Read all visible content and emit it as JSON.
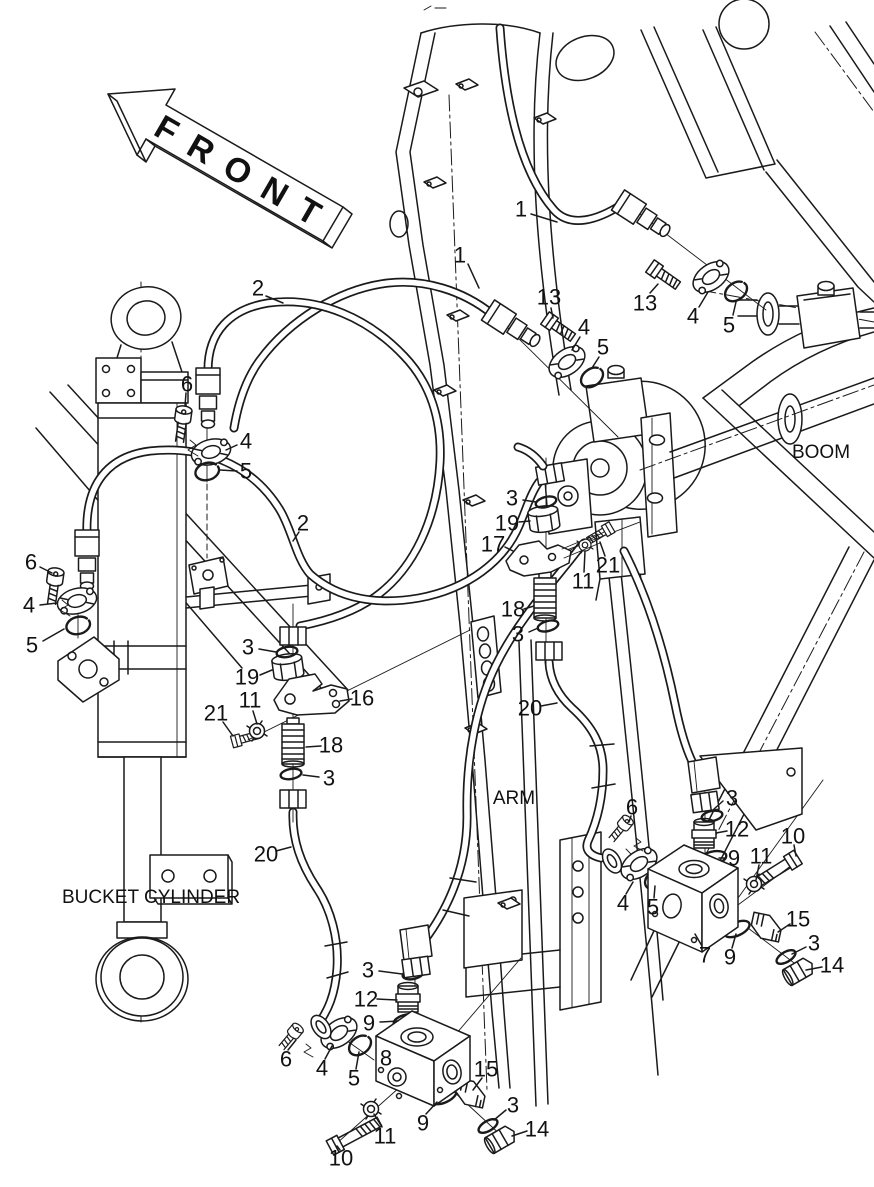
{
  "diagram": {
    "type": "exploded-parts-diagram",
    "labels": {
      "front": "FRONT",
      "boom": "BOOM",
      "arm": "ARM",
      "bucket_cylinder": "BUCKET CYLINDER"
    },
    "watermark": "www.simbrottoo.kz",
    "colors": {
      "line": "#1a1a1a",
      "background": "#ffffff",
      "watermark": "#bdbdbd"
    },
    "callouts": [
      {
        "n": "1",
        "x": 460,
        "y": 255,
        "leader": [
          468,
          264,
          479,
          288
        ]
      },
      {
        "n": "1",
        "x": 521,
        "y": 209,
        "leader": [
          531,
          214,
          557,
          222
        ]
      },
      {
        "n": "2",
        "x": 258,
        "y": 288,
        "leader": [
          266,
          296,
          283,
          303
        ]
      },
      {
        "n": "13",
        "x": 549,
        "y": 297,
        "leader": [
          551,
          308,
          553,
          318
        ]
      },
      {
        "n": "4",
        "x": 584,
        "y": 327,
        "leader": [
          580,
          337,
          572,
          350
        ]
      },
      {
        "n": "5",
        "x": 603,
        "y": 347,
        "leader": [
          599,
          357,
          592,
          368
        ]
      },
      {
        "n": "13",
        "x": 645,
        "y": 303,
        "leader": [
          650,
          293,
          658,
          284
        ]
      },
      {
        "n": "4",
        "x": 693,
        "y": 316,
        "leader": [
          699,
          307,
          708,
          292
        ]
      },
      {
        "n": "5",
        "x": 729,
        "y": 325,
        "leader": [
          733,
          315,
          736,
          302
        ]
      },
      {
        "n": "6",
        "x": 187,
        "y": 384,
        "leader": [
          186,
          393,
          185,
          406
        ]
      },
      {
        "n": "4",
        "x": 246,
        "y": 441,
        "leader": [
          237,
          445,
          226,
          450
        ]
      },
      {
        "n": "5",
        "x": 246,
        "y": 471,
        "leader": [
          237,
          471,
          220,
          470
        ]
      },
      {
        "n": "2",
        "x": 303,
        "y": 523,
        "leader": [
          299,
          532,
          293,
          541
        ]
      },
      {
        "n": "6",
        "x": 31,
        "y": 562,
        "leader": [
          40,
          567,
          52,
          573
        ]
      },
      {
        "n": "4",
        "x": 29,
        "y": 605,
        "leader": [
          40,
          605,
          57,
          603
        ]
      },
      {
        "n": "5",
        "x": 32,
        "y": 645,
        "leader": [
          43,
          641,
          64,
          629
        ]
      },
      {
        "n": "3",
        "x": 248,
        "y": 647,
        "leader": [
          259,
          649,
          276,
          652
        ]
      },
      {
        "n": "19",
        "x": 247,
        "y": 677,
        "leader": [
          260,
          675,
          272,
          670
        ]
      },
      {
        "n": "11",
        "x": 250,
        "y": 700,
        "leader": [
          253,
          711,
          257,
          724
        ]
      },
      {
        "n": "21",
        "x": 216,
        "y": 713,
        "leader": [
          223,
          722,
          233,
          736
        ]
      },
      {
        "n": "16",
        "x": 362,
        "y": 698,
        "leader": [
          352,
          699,
          340,
          701
        ]
      },
      {
        "n": "18",
        "x": 331,
        "y": 745,
        "leader": [
          321,
          746,
          306,
          747
        ]
      },
      {
        "n": "3",
        "x": 329,
        "y": 778,
        "leader": [
          319,
          777,
          303,
          775
        ]
      },
      {
        "n": "20",
        "x": 266,
        "y": 854,
        "leader": [
          276,
          851,
          291,
          847
        ]
      },
      {
        "n": "3",
        "x": 512,
        "y": 498,
        "leader": [
          523,
          500,
          536,
          502
        ]
      },
      {
        "n": "19",
        "x": 507,
        "y": 523,
        "leader": [
          519,
          522,
          530,
          521
        ]
      },
      {
        "n": "17",
        "x": 493,
        "y": 544,
        "leader": [
          505,
          547,
          513,
          551
        ]
      },
      {
        "n": "21",
        "x": 608,
        "y": 565,
        "leader": [
          605,
          556,
          600,
          542
        ]
      },
      {
        "n": "11",
        "x": 583,
        "y": 581,
        "leader": [
          584,
          572,
          585,
          551
        ]
      },
      {
        "n": "18",
        "x": 513,
        "y": 609,
        "leader": [
          524,
          609,
          534,
          606
        ]
      },
      {
        "n": "3",
        "x": 518,
        "y": 634,
        "leader": [
          529,
          632,
          538,
          628
        ]
      },
      {
        "n": "20",
        "x": 530,
        "y": 708,
        "leader": [
          541,
          706,
          557,
          703
        ]
      },
      {
        "n": "6",
        "x": 632,
        "y": 807,
        "leader": [
          631,
          816,
          629,
          822
        ]
      },
      {
        "n": "3",
        "x": 732,
        "y": 798,
        "leader": [
          723,
          801,
          714,
          809
        ]
      },
      {
        "n": "12",
        "x": 737,
        "y": 829,
        "leader": [
          727,
          831,
          716,
          833
        ]
      },
      {
        "n": "10",
        "x": 793,
        "y": 836,
        "leader": [
          794,
          845,
          796,
          856
        ]
      },
      {
        "n": "11",
        "x": 761,
        "y": 856,
        "leader": [
          759,
          865,
          756,
          880
        ]
      },
      {
        "n": "9",
        "x": 734,
        "y": 858,
        "leader": [
          725,
          858,
          719,
          858
        ]
      },
      {
        "n": "4",
        "x": 623,
        "y": 903,
        "leader": [
          626,
          894,
          633,
          882
        ]
      },
      {
        "n": "5",
        "x": 653,
        "y": 907,
        "leader": [
          654,
          898,
          655,
          886
        ]
      },
      {
        "n": "7",
        "x": 705,
        "y": 955,
        "leader": [
          702,
          946,
          695,
          934
        ]
      },
      {
        "n": "9",
        "x": 730,
        "y": 957,
        "leader": [
          732,
          948,
          736,
          934
        ]
      },
      {
        "n": "15",
        "x": 798,
        "y": 919,
        "leader": [
          790,
          924,
          778,
          932
        ]
      },
      {
        "n": "3",
        "x": 814,
        "y": 943,
        "leader": [
          806,
          947,
          792,
          954
        ]
      },
      {
        "n": "14",
        "x": 832,
        "y": 965,
        "leader": [
          822,
          967,
          806,
          970
        ]
      },
      {
        "n": "3",
        "x": 368,
        "y": 970,
        "leader": [
          379,
          971,
          402,
          974
        ]
      },
      {
        "n": "12",
        "x": 366,
        "y": 999,
        "leader": [
          377,
          999,
          397,
          1000
        ]
      },
      {
        "n": "9",
        "x": 369,
        "y": 1023,
        "leader": [
          380,
          1022,
          398,
          1021
        ]
      },
      {
        "n": "6",
        "x": 286,
        "y": 1059,
        "leader": [
          288,
          1050,
          296,
          1040
        ]
      },
      {
        "n": "4",
        "x": 322,
        "y": 1068,
        "leader": [
          325,
          1059,
          332,
          1046
        ]
      },
      {
        "n": "5",
        "x": 354,
        "y": 1078,
        "leader": [
          356,
          1069,
          359,
          1052
        ]
      },
      {
        "n": "8",
        "x": 386,
        "y": 1058,
        "leader": null
      },
      {
        "n": "15",
        "x": 486,
        "y": 1069,
        "leader": [
          482,
          1078,
          473,
          1090
        ]
      },
      {
        "n": "3",
        "x": 513,
        "y": 1105,
        "leader": [
          506,
          1110,
          494,
          1120
        ]
      },
      {
        "n": "14",
        "x": 537,
        "y": 1129,
        "leader": [
          527,
          1131,
          512,
          1136
        ]
      },
      {
        "n": "9",
        "x": 423,
        "y": 1123,
        "leader": [
          426,
          1114,
          437,
          1102
        ]
      },
      {
        "n": "11",
        "x": 385,
        "y": 1136,
        "leader": [
          382,
          1127,
          374,
          1114
        ]
      },
      {
        "n": "10",
        "x": 341,
        "y": 1158,
        "leader": [
          340,
          1150,
          337,
          1146
        ]
      }
    ]
  }
}
